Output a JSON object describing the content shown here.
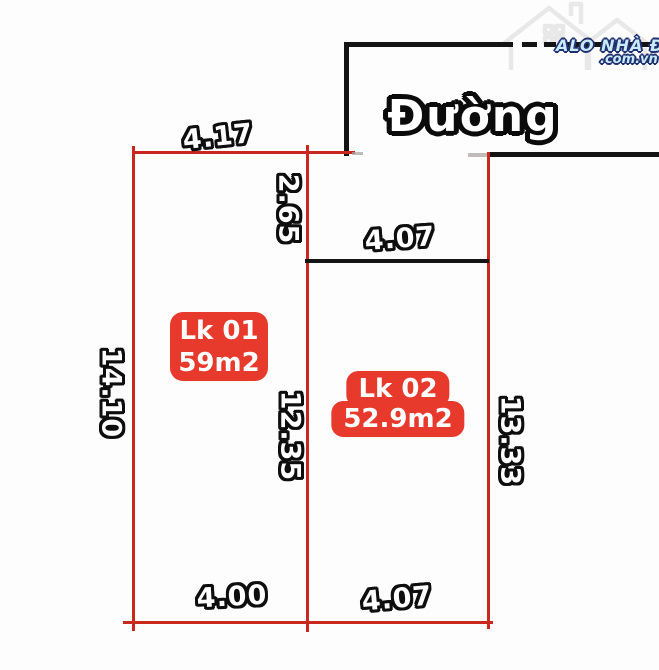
{
  "watermark": {
    "brand": "ALO NHÀ ĐẤT",
    "domain": ".com.vn"
  },
  "road": {
    "label": "Đường"
  },
  "plots": [
    {
      "id": "Lk 01",
      "area": "59m2"
    },
    {
      "id": "Lk 02",
      "area": "52.9m2"
    }
  ],
  "dimensions": {
    "plot1_top": "4.17",
    "plot2_front_depth": "2.65",
    "plot2_top": "4.07",
    "plot1_left": "14.10",
    "divider": "12.35",
    "plot2_right": "13.33",
    "plot1_bottom": "4.00",
    "plot2_bottom": "4.07"
  },
  "colors": {
    "line_red": "#c9281e",
    "line_black": "#141414",
    "badge_red": "#e83a2c",
    "logo_blue": "#c7ebf8",
    "logo_navy": "#223070"
  }
}
